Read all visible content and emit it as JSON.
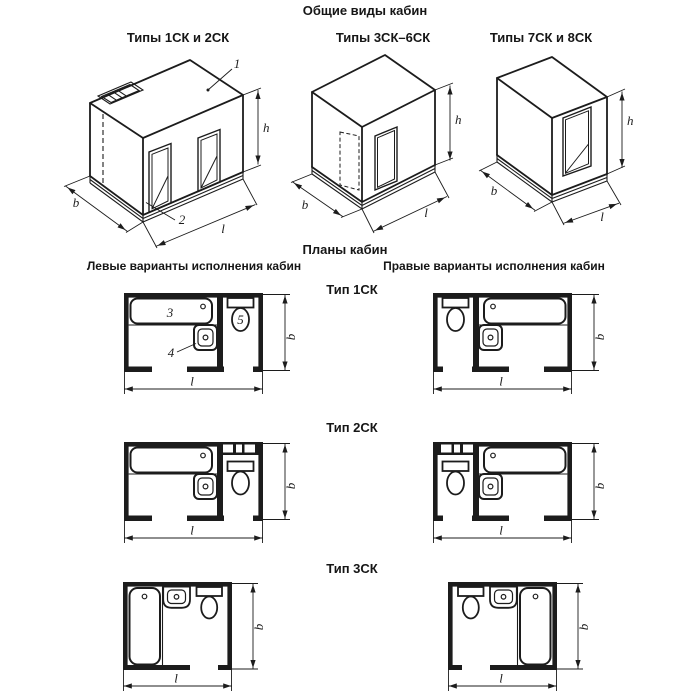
{
  "colors": {
    "ink": "#1c1c1c",
    "background": "#ffffff"
  },
  "general_views": {
    "title": "Общие виды кабин",
    "figures": [
      {
        "caption": "Типы 1СК и 2СК"
      },
      {
        "caption": "Типы 3СК–6СК"
      },
      {
        "caption": "Типы 7СК и 8СК"
      }
    ]
  },
  "plans": {
    "title": "Планы кабин",
    "left_heading": "Левые варианты исполнения кабин",
    "right_heading": "Правые варианты исполнения кабин",
    "rows": [
      {
        "label": "Тип 1СК"
      },
      {
        "label": "Тип 2СК"
      },
      {
        "label": "Тип 3СК"
      }
    ]
  },
  "callouts": {
    "ventilation_unit": "1",
    "base": "2",
    "bathtub": "3",
    "washbasin": "4",
    "toilet": "5"
  },
  "dim_labels": {
    "width": "b",
    "length": "l",
    "height": "h"
  }
}
